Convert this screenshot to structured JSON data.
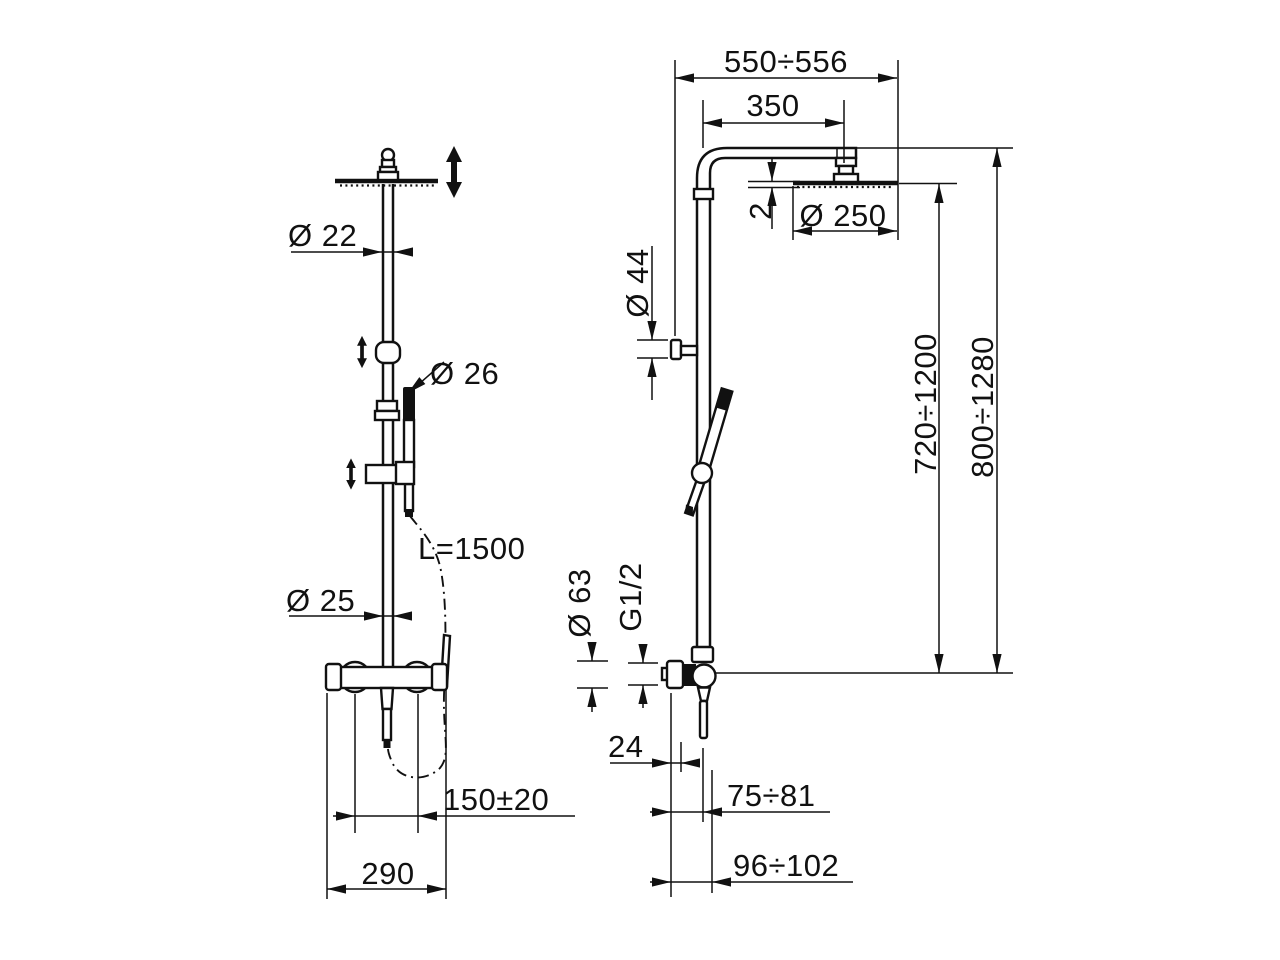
{
  "drawing": {
    "type": "technical-dimension-drawing",
    "subject": "Wall-mounted shower column with overhead shower, hand shower and exposed mixer (front and side views)",
    "colors": {
      "line": "#111111",
      "background": "#ffffff"
    },
    "symbols": {
      "height_adjustment_icon": "double-headed-vertical-arrow",
      "hose_routing_line": "dash-dot-curve"
    },
    "views": {
      "front": {
        "name": "front view",
        "dimensions": {
          "upper_pipe_diameter": "Ø 22",
          "hand_shower_diameter": "Ø 26",
          "hose_length": "L=1500",
          "lower_pipe_diameter": "Ø 25",
          "supply_connection_spacing": "150±20",
          "mixer_overall_width": "290"
        }
      },
      "side": {
        "name": "side view",
        "dimensions": {
          "wall_to_head_edge": "550÷556",
          "arm_projection": "350",
          "head_diameter": "Ø 250",
          "head_thickness": "2",
          "wall_bracket_diameter": "Ø 44",
          "riser_adjustable_height": "720÷1200",
          "overall_adjustable_height": "800÷1280",
          "escutcheon_diameter": "Ø 63",
          "connection_thread": "G1/2",
          "escutcheon_depth": "24",
          "wall_to_riser_axis": "75÷81",
          "wall_to_riser_front": "96÷102"
        }
      }
    }
  }
}
